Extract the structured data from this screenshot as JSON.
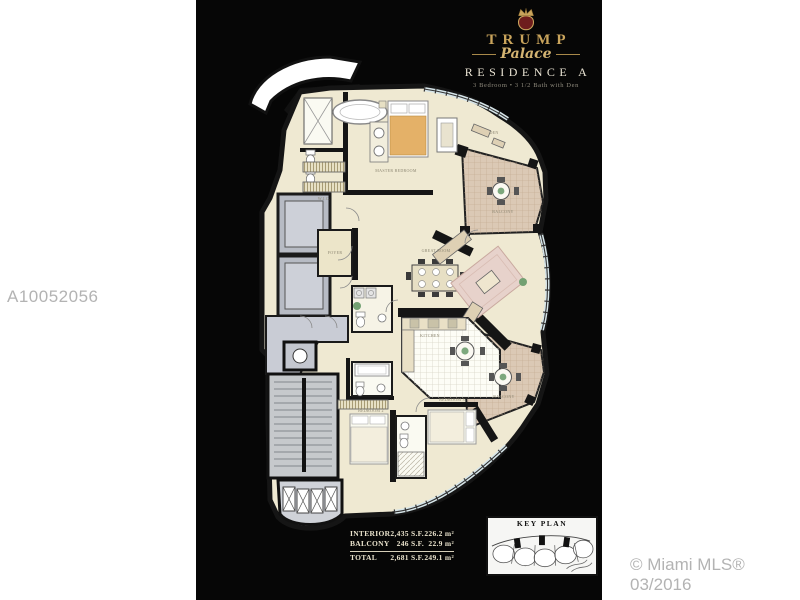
{
  "photo": {
    "background": "#060606"
  },
  "watermarks": {
    "listing_id": "A10052056",
    "copyright": "© Miami MLS® 03/2016"
  },
  "logo": {
    "brand": "TRUMP",
    "script": "Palace",
    "residence": "RESIDENCE A",
    "subtitle": "3 Bedroom • 3 1/2 Bath with Den"
  },
  "area_table": {
    "rows": [
      {
        "label": "INTERIOR",
        "sf": "2,435 S.F.",
        "sm": "226.2 m²"
      },
      {
        "label": "BALCONY",
        "sf": "246 S.F.",
        "sm": "22.9 m²"
      },
      {
        "label": "TOTAL",
        "sf": "2,681 S.F.",
        "sm": "249.1 m²"
      }
    ]
  },
  "key_plan": {
    "title": "KEY PLAN"
  },
  "floor_plan": {
    "rooms": {
      "master_bedroom": "MASTER BEDROOM",
      "great_room": "GREAT ROOM",
      "kitchen": "KITCHEN",
      "den": "DEN",
      "foyer": "FOYER",
      "wic": "W.I.C.",
      "balcony_upper": "BALCONY",
      "balcony_lower": "BALCONY",
      "bedroom_2": "BEDROOM 2",
      "bedroom_3": "BEDROOM 3"
    }
  },
  "colors": {
    "gold": "#c9a45c",
    "cream_room": "#efe9d2",
    "terrace_tan": "#dbc9b5",
    "core_gray": "#c6c9d1",
    "wall_black": "#151515",
    "watermark_gray": "#b3b3b3"
  }
}
